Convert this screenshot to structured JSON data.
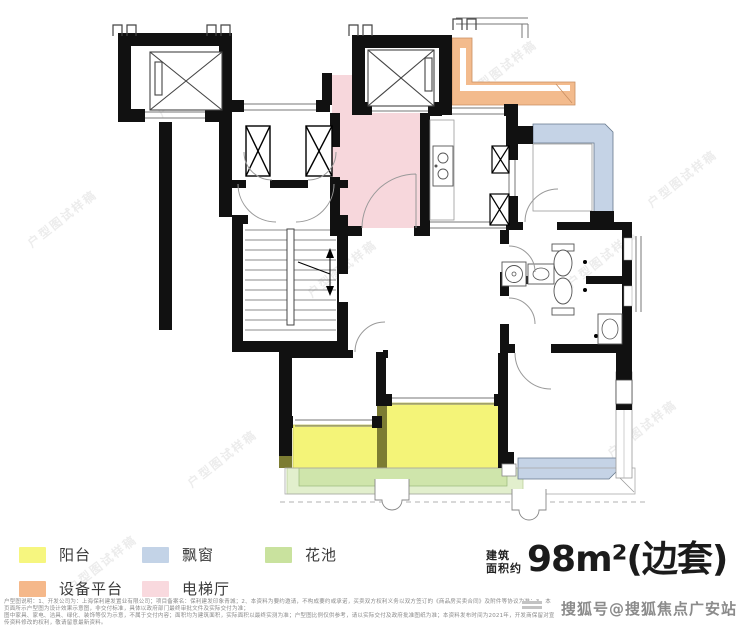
{
  "plan": {
    "watermark_text": "户型图试样稿"
  },
  "legend": {
    "items": [
      {
        "label": "阳台",
        "color": "#f6f67f"
      },
      {
        "label": "飘窗",
        "color": "#c3d3e7"
      },
      {
        "label": "花池",
        "color": "#c9e29e"
      },
      {
        "label": "设备平台",
        "color": "#f5b88a"
      },
      {
        "label": "电梯厅",
        "color": "#f9d9de"
      }
    ]
  },
  "area": {
    "prefix_line1": "建筑",
    "prefix_line2": "面积约",
    "value": "98m²(边套)"
  },
  "colors": {
    "balcony": "#f4f478",
    "bay_window": "#c5d3e6",
    "flower_bed": "#cfe5ab",
    "flower_bed_light": "#e2efcd",
    "equipment_platform": "#f3bb8d",
    "elevator_hall": "#f7d7dc",
    "wall": "#111111",
    "divider_olive": "#7c7c32"
  },
  "disclaimer": {
    "line1": "户型图说明：1、开发公司为：上海保利建发置业有限公司；项目备案名：保利建发印象青城；2、本资料为要约邀请，不构成要约或承诺，买卖双方权利义务以双方签订的《商品房买卖合同》及附件等协议为准；3、本页面所示户型图为设计效果示意图，非交付标准，具体以政府部门最终审批文件及实际交付为准；",
    "line2": "图中家具、家电、洁具、绿化、装饰等仅为示意，不属于交付内容；面积均为建筑面积，实际面积以最终实测为准；户型图比例仅供参考，请以实际交付及政府批准图纸为准；本资料发布时间为2021年，开发商保留对宣传资料修改的权利，敬请留意最新资料。"
  },
  "footer_watermark": {
    "text": "搜狐号@搜狐焦点广安站"
  }
}
